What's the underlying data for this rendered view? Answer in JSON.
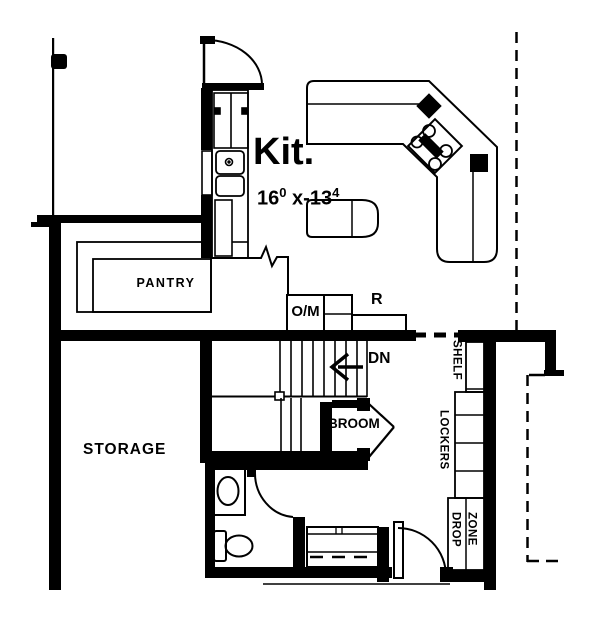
{
  "title": "Basement / kitchen floor plan",
  "colors": {
    "line": "#000000",
    "background": "#ffffff"
  },
  "labels": {
    "kitchen_title": "Kit.",
    "dim_width": "16",
    "dim_width_sup": "0",
    "dim_sep": "x-13",
    "dim_height_sup": "4",
    "pantry": "PANTRY",
    "oven_microwave": "O/M",
    "refrigerator": "R",
    "stairs_down": "DN",
    "broom_closet": "BROOM",
    "storage": "STORAGE",
    "shelf": "SHELF",
    "lockers": "LOCKERS",
    "drop": "DROP",
    "zone": "ZONE"
  }
}
